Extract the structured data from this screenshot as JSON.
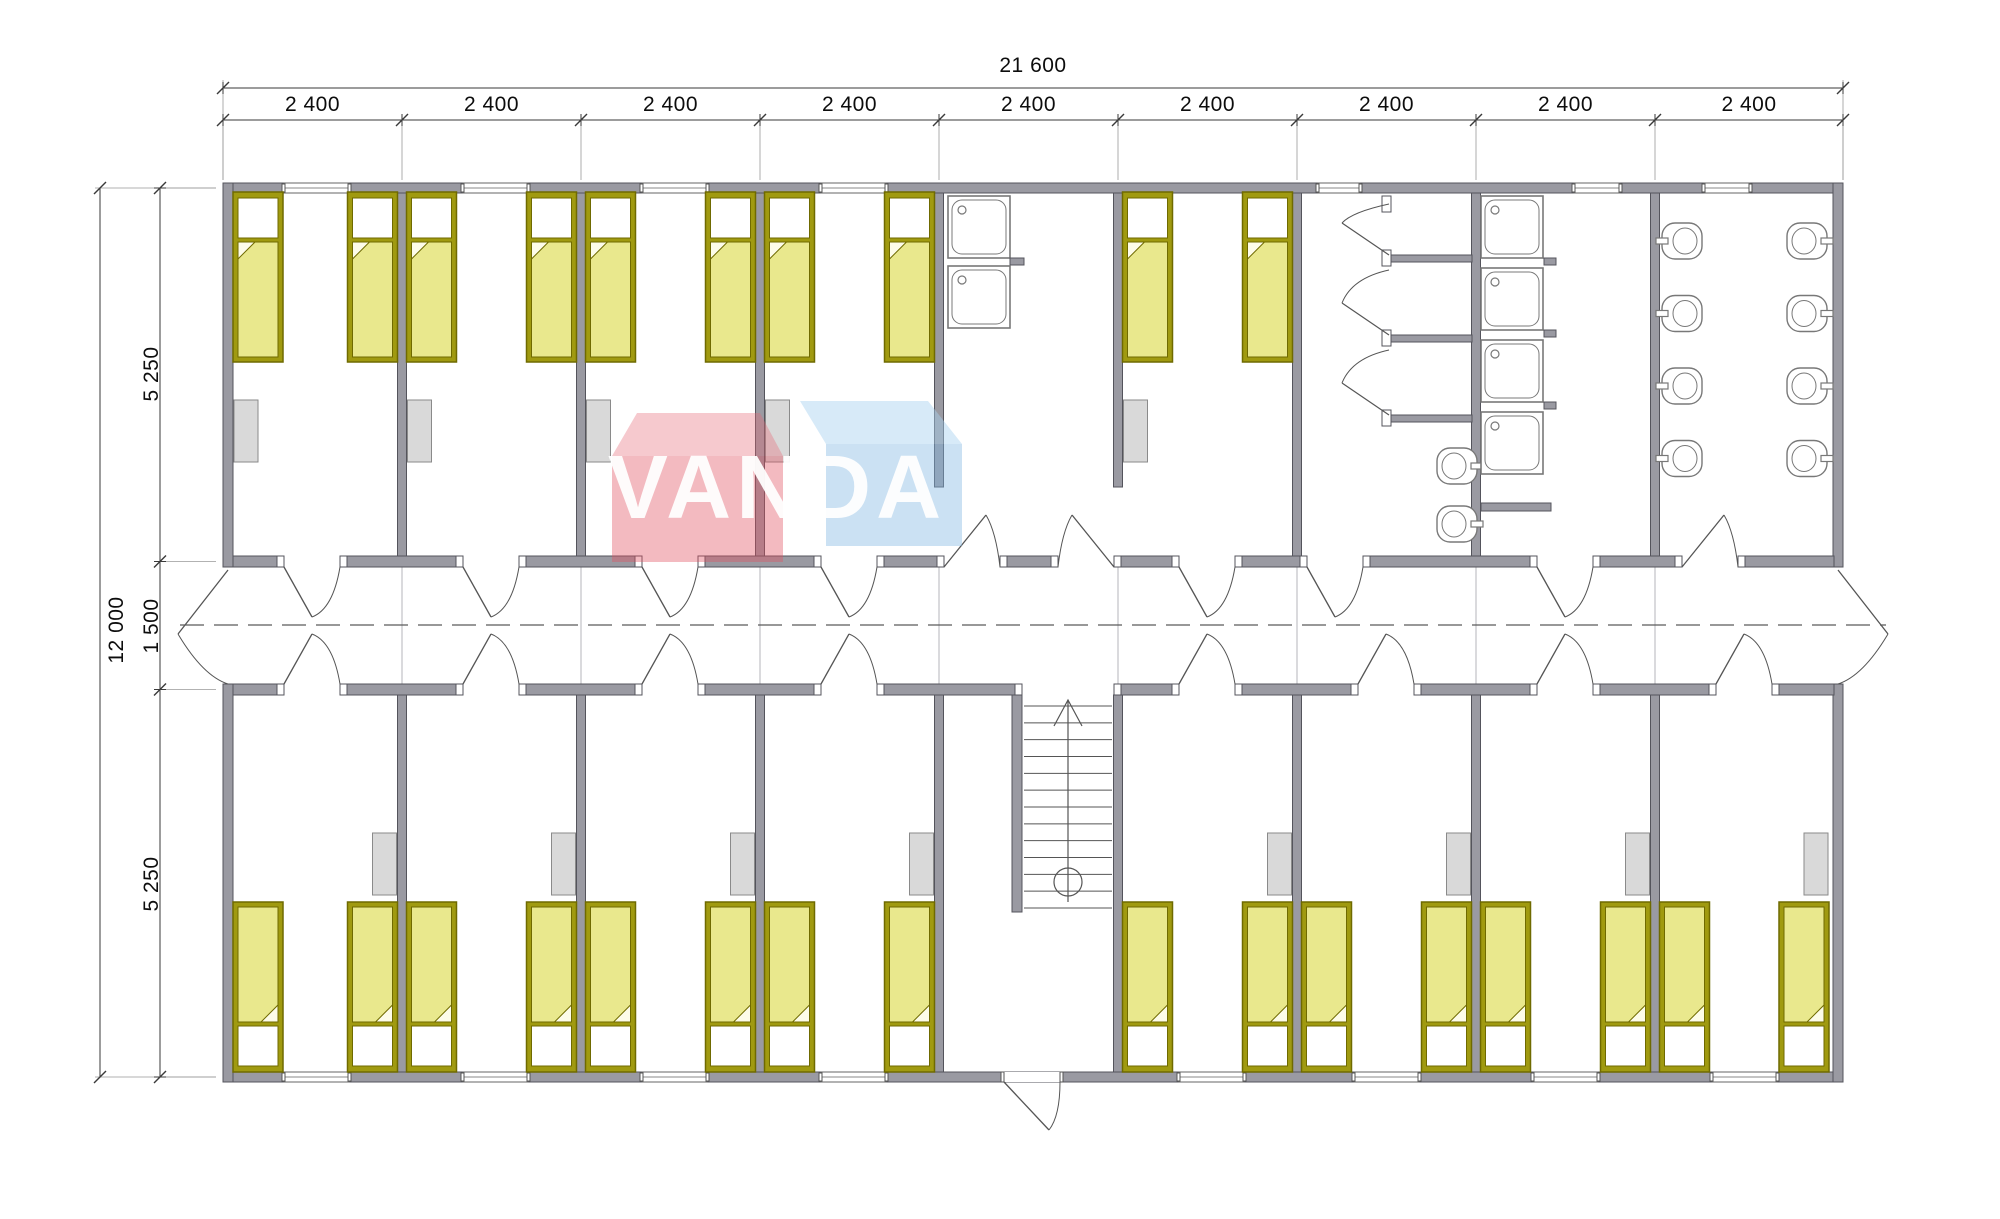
{
  "watermark": {
    "text": "VANDA",
    "red_front": "rgba(226,82,98,0.40)",
    "red_top": "rgba(231,105,120,0.36)",
    "blue_front": "rgba(130,183,226,0.42)",
    "blue_top": "rgba(168,210,240,0.46)",
    "text_color": "#ffffff"
  },
  "dimensions": {
    "top_total": "21 600",
    "top_segments": [
      "2 400",
      "2 400",
      "2 400",
      "2 400",
      "2 400",
      "2 400",
      "2 400",
      "2 400",
      "2 400"
    ],
    "left_total": "12 000",
    "left_segments": [
      "5 250",
      "1 500",
      "5 250"
    ]
  },
  "colors": {
    "wall": "#9a9aa2",
    "wall_stroke": "#54545c",
    "bed_frame": "#a09a10",
    "bed_frame_stroke": "#6f6a00",
    "mattress": "#e9e88d",
    "pillow": "#ffffff",
    "wardrobe": "#d9d9d9",
    "wardrobe_stroke": "#8a8a8a",
    "fixture_stroke": "#787878",
    "dim_line": "#3a3a3a",
    "guide": "#b5b5bb",
    "centerline": "#5a5a5a"
  },
  "plan": {
    "beds_total": 26,
    "beds_per_room": 2,
    "top_row_bedrooms": 5,
    "bottom_row_bedrooms": 8,
    "wardrobes_total": 13,
    "utility_room": {
      "square_basins": 2
    },
    "wc_room": {
      "stalls": 3,
      "oval_basins": 2
    },
    "shower_room": {
      "shower_trays": 4
    },
    "washroom": {
      "oval_basins_per_side": 4,
      "sides": 2
    },
    "stair": {
      "treads": 13
    },
    "corridor": {
      "exterior_doors": 3
    }
  }
}
